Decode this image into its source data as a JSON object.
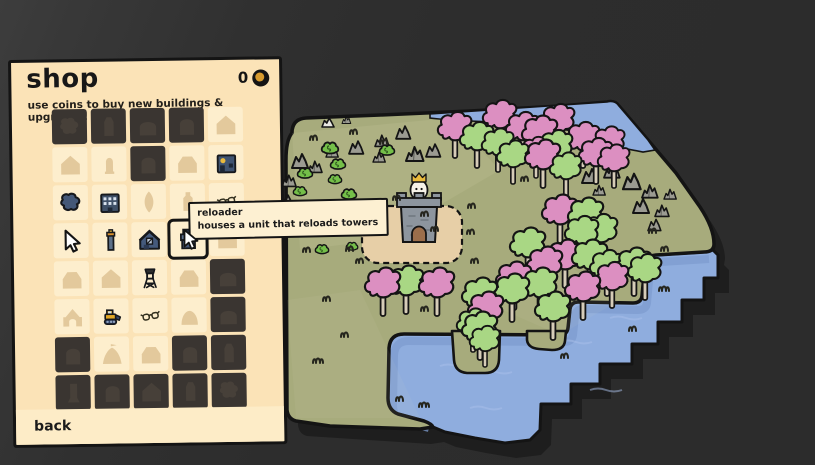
{
  "shop": {
    "title": "shop",
    "subtitle": "use coins to buy new buildings & upgrades!",
    "coins": "0",
    "back_label": "back",
    "tooltip": {
      "title": "reloader",
      "description": "houses a unit that reloads towers"
    },
    "grid": [
      {
        "state": "locked",
        "icon": "blob"
      },
      {
        "state": "locked",
        "icon": "tower"
      },
      {
        "state": "locked",
        "icon": "dome"
      },
      {
        "state": "locked",
        "icon": "arch"
      },
      {
        "state": "tan",
        "icon": "house"
      },
      {
        "state": "tan",
        "icon": "house"
      },
      {
        "state": "tan",
        "icon": "statue"
      },
      {
        "state": "locked",
        "icon": "arch"
      },
      {
        "state": "tan",
        "icon": "house2"
      },
      {
        "state": "colored",
        "icon": "blue_house"
      },
      {
        "state": "colored",
        "icon": "pond"
      },
      {
        "state": "colored",
        "icon": "apartments"
      },
      {
        "state": "tan",
        "icon": "leaf"
      },
      {
        "state": "tan",
        "icon": "bottle"
      },
      {
        "state": "colored",
        "icon": "glasses"
      },
      {
        "state": "colored",
        "icon": "cursor"
      },
      {
        "state": "colored",
        "icon": "chimney"
      },
      {
        "state": "colored",
        "icon": "barn"
      },
      {
        "state": "selected",
        "icon": "reloader"
      },
      {
        "state": "tan",
        "icon": "house"
      },
      {
        "state": "tan",
        "icon": "house2"
      },
      {
        "state": "tan",
        "icon": "house"
      },
      {
        "state": "colored",
        "icon": "watchtower"
      },
      {
        "state": "tan",
        "icon": "house2"
      },
      {
        "state": "locked",
        "icon": "dome"
      },
      {
        "state": "tan",
        "icon": "well"
      },
      {
        "state": "colored",
        "icon": "bulldozer"
      },
      {
        "state": "colored",
        "icon": "glasses"
      },
      {
        "state": "tan",
        "icon": "mound"
      },
      {
        "state": "locked",
        "icon": "dome"
      },
      {
        "state": "locked",
        "icon": "arch"
      },
      {
        "state": "tan",
        "icon": "tent"
      },
      {
        "state": "tan",
        "icon": "house2"
      },
      {
        "state": "locked",
        "icon": "arch"
      },
      {
        "state": "locked",
        "icon": "tower"
      },
      {
        "state": "locked",
        "icon": "pillar"
      },
      {
        "state": "locked",
        "icon": "arch"
      },
      {
        "state": "locked",
        "icon": "house"
      },
      {
        "state": "locked",
        "icon": "tower"
      },
      {
        "state": "locked",
        "icon": "blob"
      }
    ]
  },
  "map": {
    "colors": {
      "background": "#2d2d2d",
      "shadow": "#1e1e1e",
      "grass": "#a7ab7c",
      "grass_light": "#e9e9c0",
      "water": "#8fadde",
      "water_shadow": "#7d9ccf",
      "wave": "#a9c0ea",
      "sand": "#e7cfa7",
      "outline": "#141414",
      "tree_green": "#a9d784",
      "tree_pink": "#dc8fc1",
      "trunk": "#d6ccb8",
      "rock": "#9b9b92",
      "rock_white": "#e8e8e2",
      "bush": "#74bf49",
      "tuft": "#25251d",
      "castle_stone": "#8d959e",
      "castle_door": "#9c6e4b",
      "king_body": "#f6f2e8",
      "crown": "#e9b93c"
    },
    "trees": [
      [
        455,
        158,
        "p",
        0.95
      ],
      [
        477,
        168,
        "g",
        0.95
      ],
      [
        500,
        146,
        "p",
        0.95
      ],
      [
        498,
        172,
        "g",
        0.9
      ],
      [
        523,
        158,
        "p",
        0.95
      ],
      [
        513,
        184,
        "g",
        0.9
      ],
      [
        540,
        164,
        "p",
        1.0
      ],
      [
        558,
        150,
        "p",
        0.95
      ],
      [
        556,
        176,
        "g",
        0.95
      ],
      [
        543,
        188,
        "p",
        1.0
      ],
      [
        566,
        196,
        "g",
        0.9
      ],
      [
        583,
        168,
        "p",
        0.95
      ],
      [
        596,
        184,
        "p",
        0.95
      ],
      [
        609,
        170,
        "p",
        0.9
      ],
      [
        614,
        188,
        "p",
        0.9
      ],
      [
        536,
        178,
        "p",
        0.85
      ],
      [
        560,
        243,
        "p",
        1.0
      ],
      [
        586,
        246,
        "g",
        1.0
      ],
      [
        601,
        260,
        "g",
        0.95
      ],
      [
        582,
        262,
        "g",
        0.95
      ],
      [
        565,
        288,
        "p",
        1.0
      ],
      [
        590,
        288,
        "g",
        1.0
      ],
      [
        528,
        276,
        "g",
        1.0
      ],
      [
        545,
        295,
        "p",
        1.0
      ],
      [
        514,
        310,
        "p",
        1.0
      ],
      [
        512,
        322,
        "g",
        1.0
      ],
      [
        540,
        316,
        "g",
        1.0
      ],
      [
        553,
        340,
        "g",
        1.0
      ],
      [
        583,
        320,
        "p",
        1.0
      ],
      [
        612,
        308,
        "p",
        0.95
      ],
      [
        607,
        296,
        "g",
        0.95
      ],
      [
        634,
        296,
        "g",
        1.0
      ],
      [
        645,
        300,
        "g",
        0.95
      ],
      [
        383,
        316,
        "p",
        1.0
      ],
      [
        406,
        314,
        "g",
        1.0
      ],
      [
        437,
        316,
        "p",
        1.0
      ],
      [
        480,
        326,
        "g",
        1.0
      ],
      [
        486,
        340,
        "p",
        1.0
      ],
      [
        480,
        360,
        "g",
        1.0
      ],
      [
        473,
        352,
        "g",
        0.9
      ],
      [
        485,
        367,
        "g",
        0.85
      ]
    ],
    "rocks": [
      [
        300,
        166,
        1.0,
        1
      ],
      [
        316,
        172,
        0.8,
        2
      ],
      [
        334,
        158,
        0.7,
        2
      ],
      [
        357,
        153,
        0.9,
        1
      ],
      [
        383,
        146,
        0.8,
        2
      ],
      [
        404,
        138,
        0.9,
        1
      ],
      [
        414,
        158,
        1.0,
        2
      ],
      [
        434,
        156,
        0.9,
        1
      ],
      [
        381,
        163,
        0.7,
        2
      ],
      [
        290,
        186,
        0.8,
        2
      ],
      [
        287,
        207,
        0.9,
        1
      ],
      [
        330,
        129,
        0.8,
        3
      ],
      [
        350,
        127,
        0.5,
        2
      ],
      [
        590,
        181,
        1.0,
        1
      ],
      [
        612,
        176,
        0.9,
        2
      ],
      [
        631,
        186,
        1.1,
        1
      ],
      [
        650,
        196,
        0.9,
        2
      ],
      [
        641,
        211,
        1.0,
        1
      ],
      [
        663,
        216,
        0.8,
        2
      ],
      [
        601,
        196,
        0.7,
        2
      ],
      [
        656,
        231,
        0.8,
        1
      ],
      [
        672,
        200,
        0.7,
        2
      ]
    ],
    "bushes": [
      [
        330,
        149,
        1.0
      ],
      [
        338,
        165,
        0.9
      ],
      [
        305,
        174,
        0.9
      ],
      [
        335,
        180,
        0.8
      ],
      [
        387,
        151,
        0.9
      ],
      [
        300,
        192,
        0.8
      ],
      [
        349,
        195,
        0.9
      ],
      [
        322,
        250,
        0.8
      ],
      [
        352,
        247,
        0.7
      ]
    ],
    "tufts": [
      [
        310,
        140,
        2
      ],
      [
        350,
        134,
        2
      ],
      [
        380,
        144,
        2
      ],
      [
        302,
        215,
        2
      ],
      [
        318,
        226,
        2
      ],
      [
        346,
        251,
        2
      ],
      [
        303,
        252,
        2
      ],
      [
        356,
        263,
        2
      ],
      [
        393,
        200,
        2
      ],
      [
        421,
        216,
        2
      ],
      [
        431,
        231,
        2
      ],
      [
        467,
        234,
        2
      ],
      [
        521,
        181,
        2
      ],
      [
        553,
        211,
        2
      ],
      [
        578,
        228,
        2
      ],
      [
        471,
        263,
        2
      ],
      [
        421,
        311,
        2
      ],
      [
        323,
        301,
        2
      ],
      [
        341,
        337,
        2
      ],
      [
        313,
        363,
        3
      ],
      [
        396,
        401,
        2
      ],
      [
        419,
        407,
        3
      ],
      [
        600,
        238,
        2
      ],
      [
        649,
        233,
        2
      ],
      [
        603,
        258,
        2
      ],
      [
        659,
        291,
        3
      ],
      [
        629,
        331,
        2
      ],
      [
        561,
        358,
        2
      ],
      [
        661,
        251,
        2
      ],
      [
        468,
        208,
        2
      ],
      [
        588,
        292,
        2
      ]
    ],
    "waves": [
      [
        440,
        366
      ],
      [
        480,
        372
      ],
      [
        560,
        342
      ],
      [
        610,
        318
      ],
      [
        470,
        408
      ],
      [
        590,
        390
      ]
    ]
  }
}
